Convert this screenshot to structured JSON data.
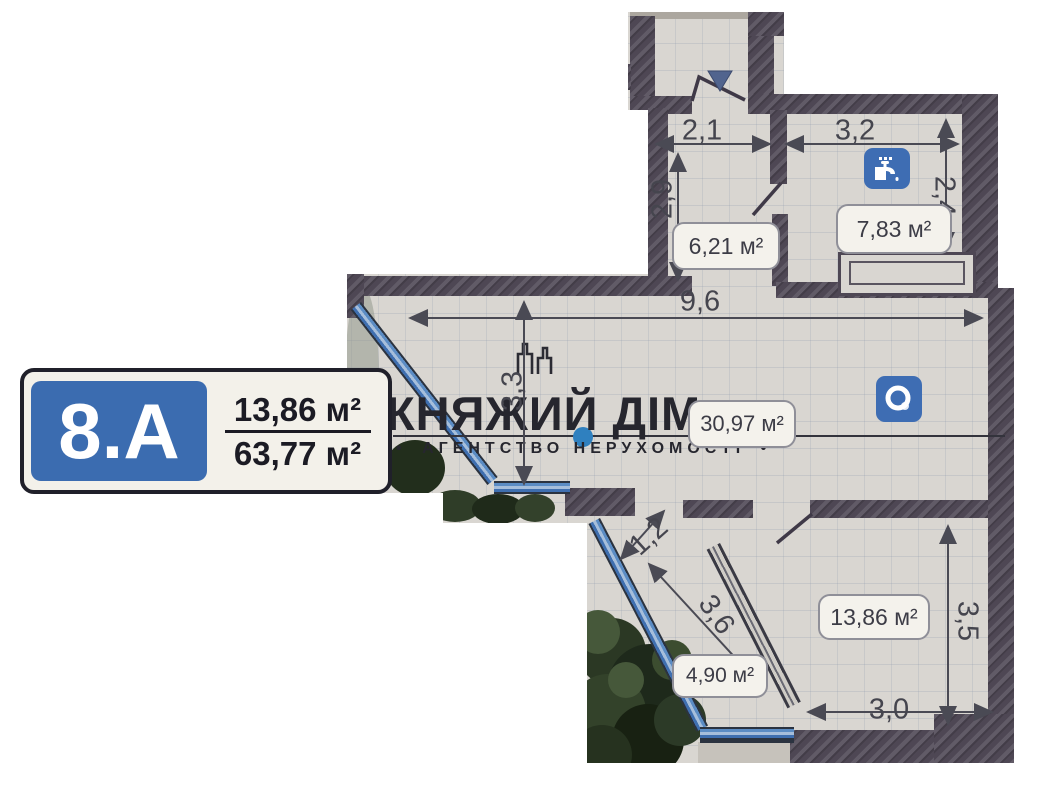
{
  "badge": {
    "unit": "8.A",
    "upper_area": "13,86 м²",
    "lower_area": "63,77 м²"
  },
  "watermark": {
    "title": "КНЯЖИЙ ДІМ",
    "subtitle": "АГЕНТСТВО НЕРУХОМОСТІ",
    "bullet_left": "•",
    "bullet_right": "•"
  },
  "rooms": {
    "hallway": "6,21 м²",
    "bathroom": "7,83 м²",
    "living_room": "30,97 м²",
    "bedroom": "13,86 м²",
    "balcony": "4,90 м²"
  },
  "dimensions": {
    "hallway_width": "2,1",
    "bathroom_width": "3,2",
    "hallway_depth": "2,9",
    "bathroom_depth": "2,4",
    "living_width": "9,6",
    "living_depth": "3,3",
    "balcony_passage": "1,2",
    "balcony_length": "3,6",
    "bedroom_depth": "3,5",
    "bedroom_width": "3,0"
  },
  "icons": {
    "faucet": "faucet-icon",
    "washing_machine": "washing-machine-icon",
    "entrance_marker": "entrance-triangle-icon",
    "logo_building": "building-logo-icon"
  },
  "colors": {
    "wall": "#4e4754",
    "glazing": "#3f6fb0",
    "badge_blue": "#3b6cb0",
    "icon_blue": "#3e6db3",
    "photo_background": "#d9d6d1",
    "ink": "#3c3c46",
    "tree_green": "#2c3a27",
    "watermark": "#26262e"
  }
}
